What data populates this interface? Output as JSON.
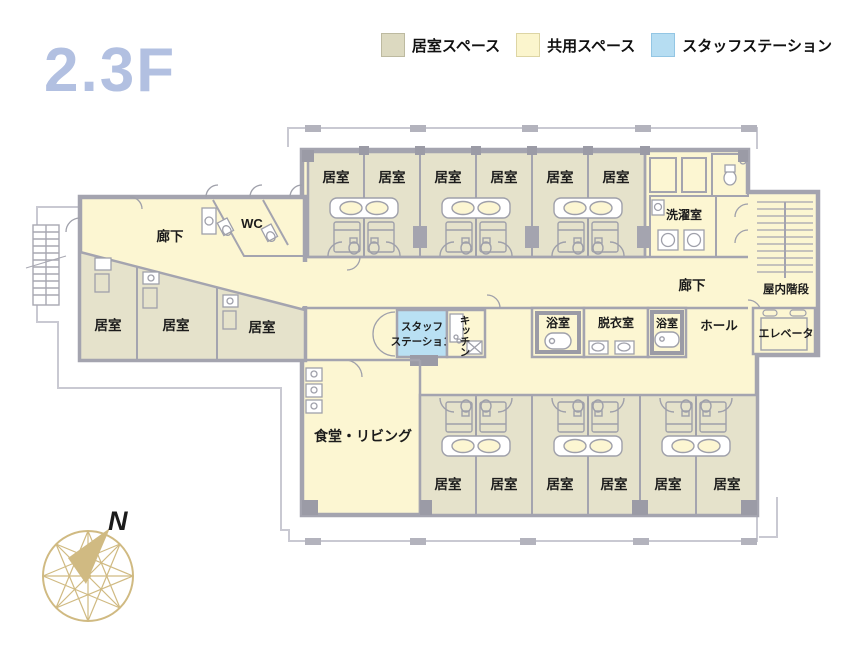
{
  "floor_title": "2.3F",
  "legend": {
    "items": [
      {
        "label": "居室スペース",
        "color": "#dcd9c0"
      },
      {
        "label": "共用スペース",
        "color": "#fbf5cd"
      },
      {
        "label": "スタッフステーション",
        "color": "#b6ddf2"
      }
    ]
  },
  "colors": {
    "resident_room": "#e5e2cb",
    "common_space": "#fcf6d2",
    "staff_station": "#b9e0f3",
    "wall": "#a4a4af",
    "wall_dark": "#9b9ba6",
    "balcony_line": "#c9c9d2",
    "compass": "#d0ba82",
    "title": "#b2c0e1"
  },
  "plan": {
    "top_rooms": [
      "居室",
      "居室",
      "居室",
      "居室",
      "居室",
      "居室"
    ],
    "bottom_rooms": [
      "居室",
      "居室",
      "居室",
      "居室",
      "居室",
      "居室"
    ],
    "left_rooms": [
      "居室",
      "居室",
      "居室"
    ],
    "labels": {
      "corridor_left": "廊下",
      "corridor_right": "廊下",
      "wc": "WC",
      "laundry": "洗濯室",
      "indoor_stairs": "屋内階段",
      "elevator": "エレベータ",
      "hall": "ホール",
      "staff_line1": "スタッフ",
      "staff_line2": "ステーション",
      "kitchen": "キッチン",
      "bath_left": "浴室",
      "bath_right": "浴室",
      "dressing": "脱衣室",
      "dining_living": "食堂・リビング"
    }
  },
  "compass": {
    "north_label": "N"
  }
}
